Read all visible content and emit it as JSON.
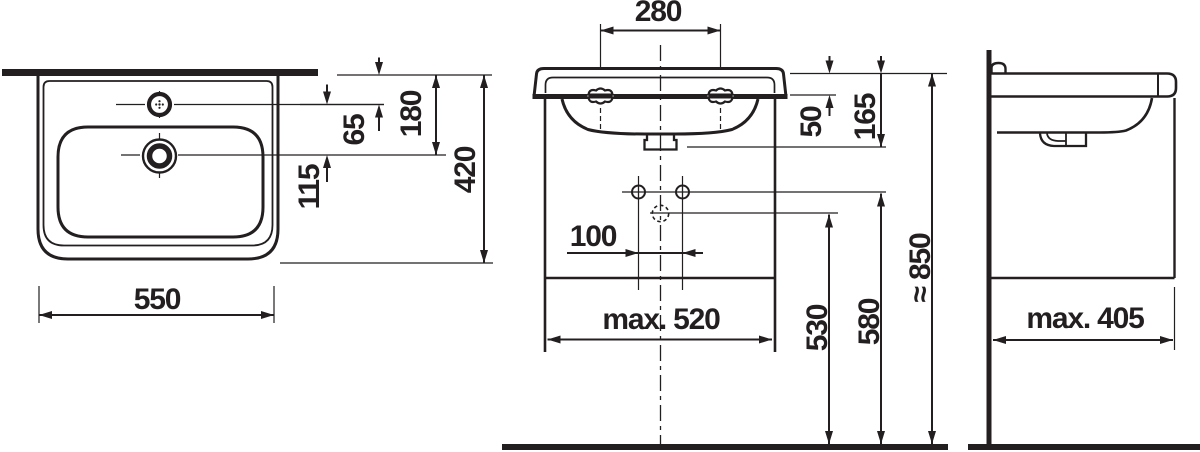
{
  "top_view": {
    "labels": {
      "width": "550",
      "depth": "420",
      "tap_offset": "65",
      "tap_to_drain": "115",
      "drain_offset": "180"
    }
  },
  "front_view": {
    "labels": {
      "tap_hole_spacing": "280",
      "rim_to_bolt": "50",
      "rim_to_outlet": "165",
      "fixing_hole_spacing": "100",
      "max_unit_width": "max. 520",
      "drain_height": "530",
      "fixing_hole_height": "580",
      "rim_height": "≈ 850"
    }
  },
  "side_view": {
    "labels": {
      "max_unit_depth": "max. 405"
    }
  },
  "colors": {
    "ink": "#231f20",
    "paper": "#ffffff"
  }
}
